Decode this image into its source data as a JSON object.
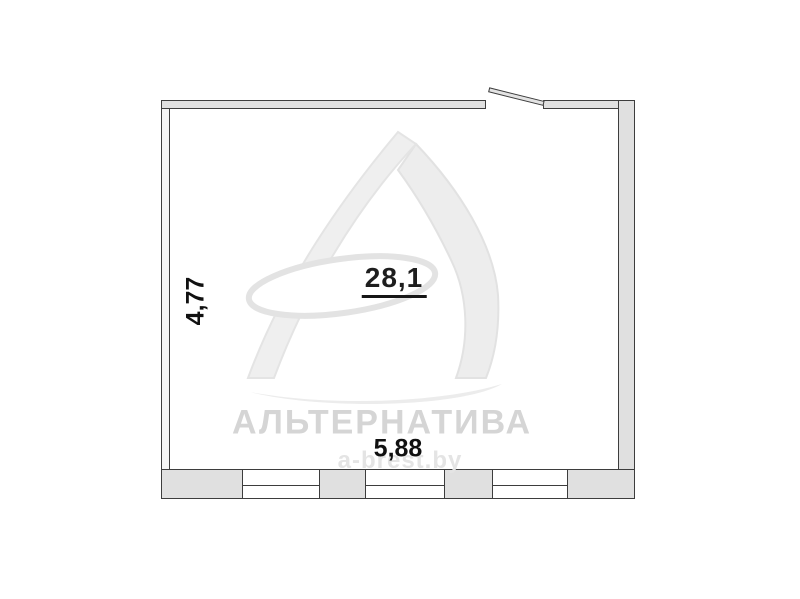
{
  "plan": {
    "area_label": "28,1",
    "dim_width": "5,88",
    "dim_height": "4,77",
    "window_count": 3,
    "door_count": 1
  },
  "watermark": {
    "brand": "АЛЬТЕРНАТИВА",
    "url": "a-brest.by"
  },
  "colors": {
    "wall_fill": "#e0e0e0",
    "wall_outline": "#3d3d3d",
    "label_text": "#1e1e1e",
    "watermark_gray": "#d5d5d5",
    "background": "#ffffff"
  }
}
